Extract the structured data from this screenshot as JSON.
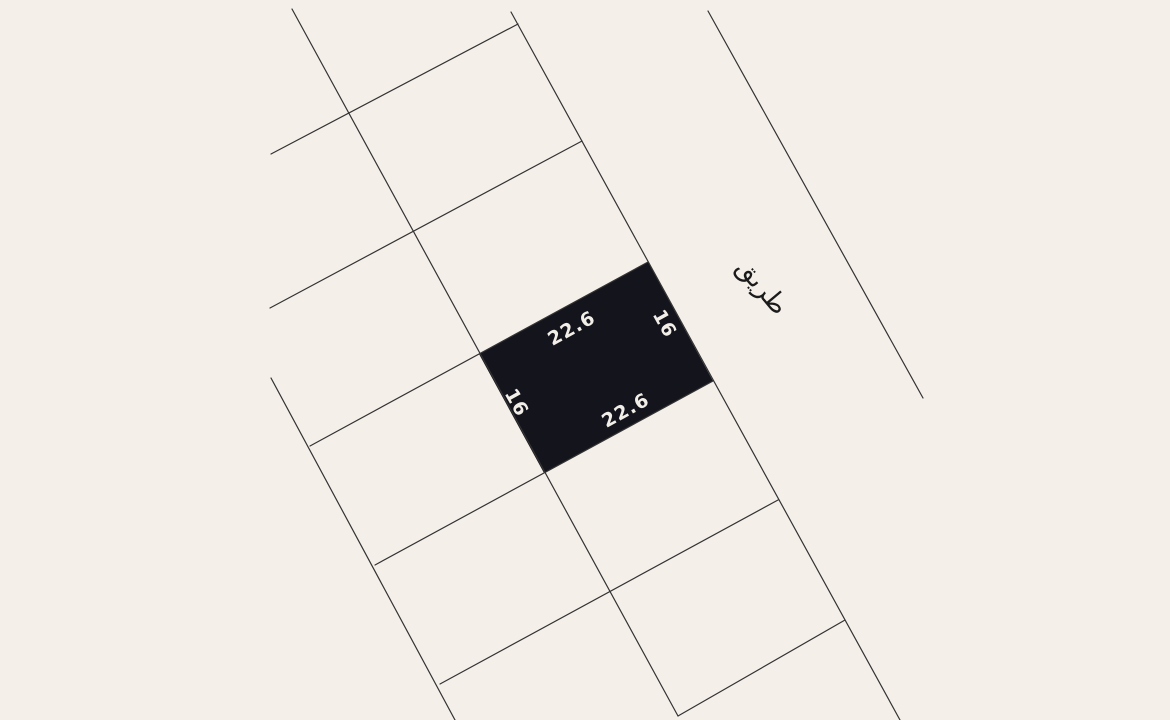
{
  "map": {
    "colors": {
      "background": "#f4efe9",
      "line": "#333333",
      "parcel_fill": "#14141d",
      "parcel_label": "#f2eee8",
      "road_label": "#1b1b1b"
    },
    "selected_parcel": {
      "width_value": "22.6",
      "depth_value": "16",
      "corners": [
        [
          479,
          354
        ],
        [
          648,
          262
        ],
        [
          713,
          381
        ],
        [
          544,
          473
        ]
      ],
      "font_size": 19,
      "labels": [
        {
          "id": "top-width",
          "text": "22.6",
          "x": 572,
          "y": 329,
          "rotate": -29
        },
        {
          "id": "right-depth",
          "text": "16",
          "x": 664,
          "y": 324,
          "rotate": 61
        },
        {
          "id": "bottom-width",
          "text": "22.6",
          "x": 626,
          "y": 411,
          "rotate": -29
        },
        {
          "id": "left-depth",
          "text": "16",
          "x": 516,
          "y": 403,
          "rotate": 61
        }
      ]
    },
    "road": {
      "label": "طريق",
      "x": 762,
      "y": 287,
      "rotate": 50,
      "font_size": 26
    },
    "grid_lines": [
      {
        "id": "column-line-0",
        "x1": 271,
        "y1": 378,
        "x2": 455,
        "y2": 720
      },
      {
        "id": "column-line-1",
        "x1": 292,
        "y1": 9,
        "x2": 678,
        "y2": 716
      },
      {
        "id": "column-line-2",
        "x1": 511,
        "y1": 12,
        "x2": 900,
        "y2": 720
      },
      {
        "id": "road-edge-line",
        "x1": 708,
        "y1": 11,
        "x2": 923,
        "y2": 398
      },
      {
        "id": "cross-line-0",
        "x1": 271,
        "y1": 154,
        "x2": 518,
        "y2": 24
      },
      {
        "id": "cross-line-1",
        "x1": 270,
        "y1": 308,
        "x2": 582,
        "y2": 141
      },
      {
        "id": "cross-line-2",
        "x1": 310,
        "y1": 446,
        "x2": 648,
        "y2": 262
      },
      {
        "id": "cross-line-3",
        "x1": 375,
        "y1": 565,
        "x2": 713,
        "y2": 381
      },
      {
        "id": "cross-line-4",
        "x1": 440,
        "y1": 684,
        "x2": 778,
        "y2": 500
      },
      {
        "id": "cross-line-5",
        "x1": 678,
        "y1": 716,
        "x2": 845,
        "y2": 620
      }
    ],
    "line_width": 1.2
  }
}
